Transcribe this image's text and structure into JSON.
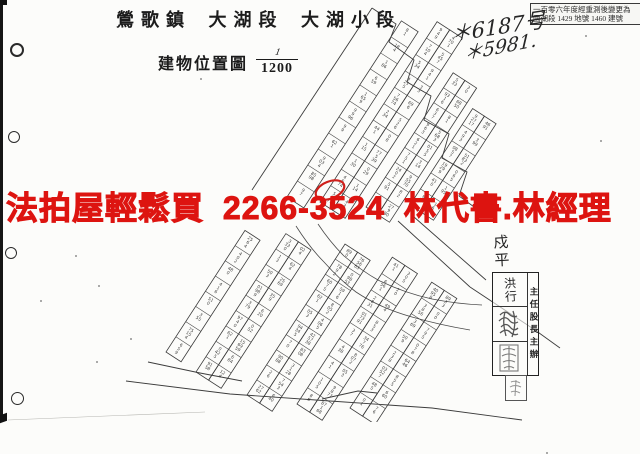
{
  "header": {
    "title": "鶯歌鎮 大湖段 大湖小段"
  },
  "map_title": {
    "label": "建物位置圖",
    "scale_numerator": "1",
    "scale_denominator": "1200"
  },
  "note_box": {
    "line1": "一百零六年度經重測後變更為",
    "line2": "國湖段 1429 地號 1460 建號"
  },
  "handwriting": {
    "line1": "＊6187号",
    "line2": "＊5981."
  },
  "ad_overlay": {
    "text": "法拍屋輕鬆買 2266-3524 林代書.林經理",
    "color": "#dd1410"
  },
  "stamp": {
    "vertical_note": "戍平",
    "signature": "洪行",
    "approval_roles": "主任股長主辦"
  },
  "map": {
    "type": "cadastral-parcel-map",
    "description_labels": []
  },
  "colors": {
    "ink": "#1c1c1c",
    "map_line": "#3c3c3c",
    "red_annotation": "#cf1f1a",
    "paper": "#fcfcfa"
  }
}
